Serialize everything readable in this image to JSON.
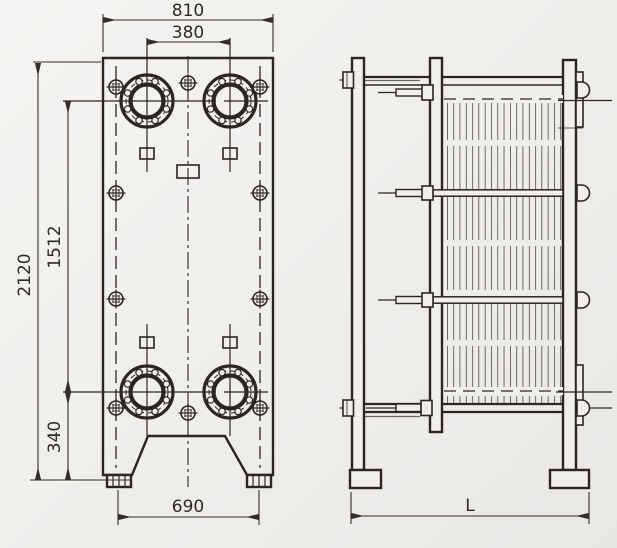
{
  "drawing": {
    "background_color": "#f0efec",
    "line_color": "#2b2622",
    "front_view": {
      "dim_overall_width": "810",
      "dim_port_spacing_horizontal": "380",
      "dim_overall_height": "2120",
      "dim_port_spacing_vertical": "1512",
      "dim_lower_port_to_base": "340",
      "dim_foot_spacing": "690"
    },
    "side_view": {
      "dim_overall_length": "L"
    }
  }
}
